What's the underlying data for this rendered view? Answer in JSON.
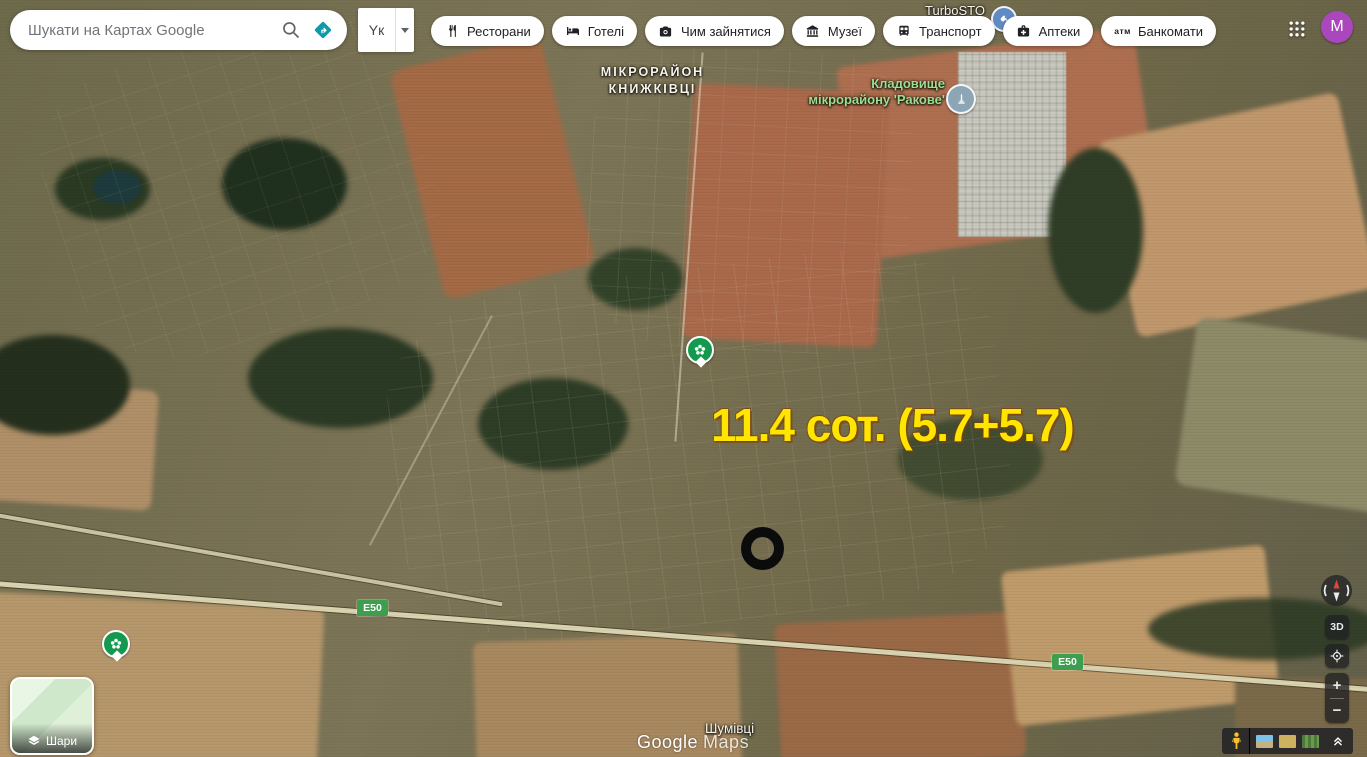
{
  "search": {
    "placeholder": "Шукати на Картах Google"
  },
  "input_tool": {
    "label": "Yк"
  },
  "chips": [
    {
      "icon": "restaurants-icon",
      "label": "Ресторани"
    },
    {
      "icon": "hotels-icon",
      "label": "Готелі"
    },
    {
      "icon": "things-to-do-icon",
      "label": "Чим зайнятися"
    },
    {
      "icon": "museums-icon",
      "label": "Музеї"
    },
    {
      "icon": "transit-icon",
      "label": "Транспорт"
    },
    {
      "icon": "pharmacies-icon",
      "label": "Аптеки"
    },
    {
      "icon": "atm-icon",
      "label": "Банкомати",
      "icon_text": "атм"
    }
  ],
  "account": {
    "avatar_letter": "M",
    "avatar_color": "#ab47bc"
  },
  "map_labels": {
    "district_line1": "МІКРОРАЙОН",
    "district_line2": "КНИЖКІВЦІ",
    "cemetery_line1": "Кладовище",
    "cemetery_line2": "мікрорайону 'Ракове'",
    "business": "TurboSTO",
    "village": "Шумівці"
  },
  "annotation": {
    "text": "11.4 сот. (5.7+5.7)",
    "color": "#FFE600"
  },
  "road_shield": {
    "label": "E50",
    "color": "#3d9e4d"
  },
  "layers_control": {
    "label": "Шари"
  },
  "nav_controls": {
    "three_d": "3D",
    "zoom_in": "+",
    "zoom_out": "−"
  },
  "watermark": {
    "part1": "Google",
    "part2": "Maps"
  }
}
